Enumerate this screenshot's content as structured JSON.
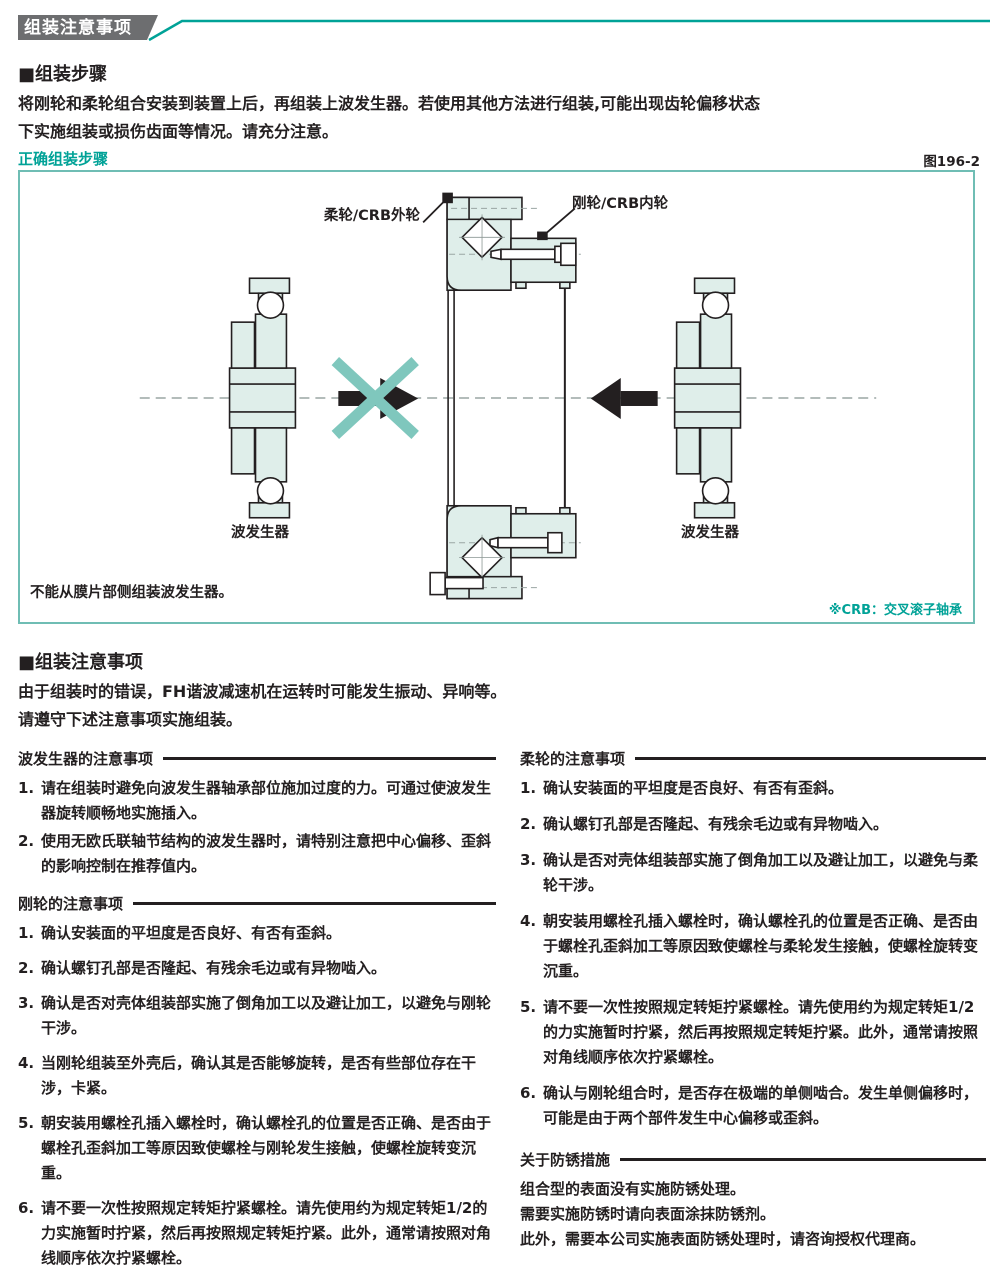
{
  "header": {
    "title": "组装注意事项"
  },
  "assembly_steps": {
    "heading": "■组装步骤",
    "line1": "将刚轮和柔轮组合安装到装置上后，再组装上波发生器。若使用其他方法进行组装,可能出现齿轮偏移状态",
    "line2": "下实施组装或损伤齿面等情况。请充分注意。"
  },
  "figure": {
    "caption": "正确组装步骤",
    "number": "图196-2",
    "label_flexspline": "柔轮/CRB外轮",
    "label_circular": "刚轮/CRB内轮",
    "label_wave_generator_left": "波发生器",
    "label_wave_generator_right": "波发生器",
    "note": "不能从膜片部侧组装波发生器。",
    "footnote": "※CRB：交叉滚子轴承"
  },
  "precautions": {
    "heading": "■组装注意事项",
    "line1": "由于组装时的错误，FH谐波减速机在运转时可能发生振动、异响等。",
    "line2": "请遵守下述注意事项实施组装。"
  },
  "wave_generator_section": {
    "title": "波发生器的注意事项",
    "items": [
      {
        "num": "1.",
        "text": "请在组装时避免向波发生器轴承部位施加过度的力。可通过使波发生器旋转顺畅地实施插入。"
      },
      {
        "num": "2.",
        "text": "使用无欧氏联轴节结构的波发生器时，请特别注意把中心偏移、歪斜的影响控制在推荐值内。"
      }
    ]
  },
  "circular_spline_section": {
    "title": "刚轮的注意事项",
    "items": [
      {
        "num": "1.",
        "text": "确认安装面的平坦度是否良好、有否有歪斜。"
      },
      {
        "num": "2.",
        "text": "确认螺钉孔部是否隆起、有残余毛边或有异物啮入。"
      },
      {
        "num": "3.",
        "text": "确认是否对壳体组装部实施了倒角加工以及避让加工，以避免与刚轮干涉。"
      },
      {
        "num": "4.",
        "text": "当刚轮组装至外壳后，确认其是否能够旋转，是否有些部位存在干涉，卡紧。"
      },
      {
        "num": "5.",
        "text": "朝安装用螺栓孔插入螺栓时，确认螺栓孔的位置是否正确、是否由于螺栓孔歪斜加工等原因致使螺栓与刚轮发生接触，使螺栓旋转变沉重。"
      },
      {
        "num": "6.",
        "text": "请不要一次性按照规定转矩拧紧螺栓。请先使用约为规定转矩1/2的力实施暂时拧紧，然后再按照规定转矩拧紧。此外，通常请按照对角线顺序依次拧紧螺栓。"
      },
      {
        "num": "7.",
        "text": "向刚轮打销子可能造成旋转精度低下，因此请尽可能避免。"
      }
    ]
  },
  "flexspline_section": {
    "title": "柔轮的注意事项",
    "items": [
      {
        "num": "1.",
        "text": "确认安装面的平坦度是否良好、有否有歪斜。"
      },
      {
        "num": "2.",
        "text": "确认螺钉孔部是否隆起、有残余毛边或有异物啮入。"
      },
      {
        "num": "3.",
        "text": "确认是否对壳体组装部实施了倒角加工以及避让加工，以避免与柔轮干涉。"
      },
      {
        "num": "4.",
        "text": "朝安装用螺栓孔插入螺栓时，确认螺栓孔的位置是否正确、是否由于螺栓孔歪斜加工等原因致使螺栓与柔轮发生接触，使螺栓旋转变沉重。"
      },
      {
        "num": "5.",
        "text": "请不要一次性按照规定转矩拧紧螺栓。请先使用约为规定转矩1/2的力实施暂时拧紧，然后再按照规定转矩拧紧。此外，通常请按照对角线顺序依次拧紧螺栓。"
      },
      {
        "num": "6.",
        "text": "确认与刚轮组合时，是否存在极端的单侧啮合。发生单侧偏移时，可能是由于两个部件发生中心偏移或歪斜。"
      }
    ]
  },
  "rust_section": {
    "title": "关于防锈措施",
    "lines": [
      "组合型的表面没有实施防锈处理。",
      "需要实施防锈时请向表面涂抹防锈剂。",
      "此外，需要本公司实施表面防锈处理时，请咨询授权代理商。"
    ]
  },
  "colors": {
    "teal": "#00a297",
    "teal_light": "#7fc7bd",
    "mint": "#dfeeea",
    "header_gray": "#6d6e70",
    "ink": "#231f20"
  }
}
